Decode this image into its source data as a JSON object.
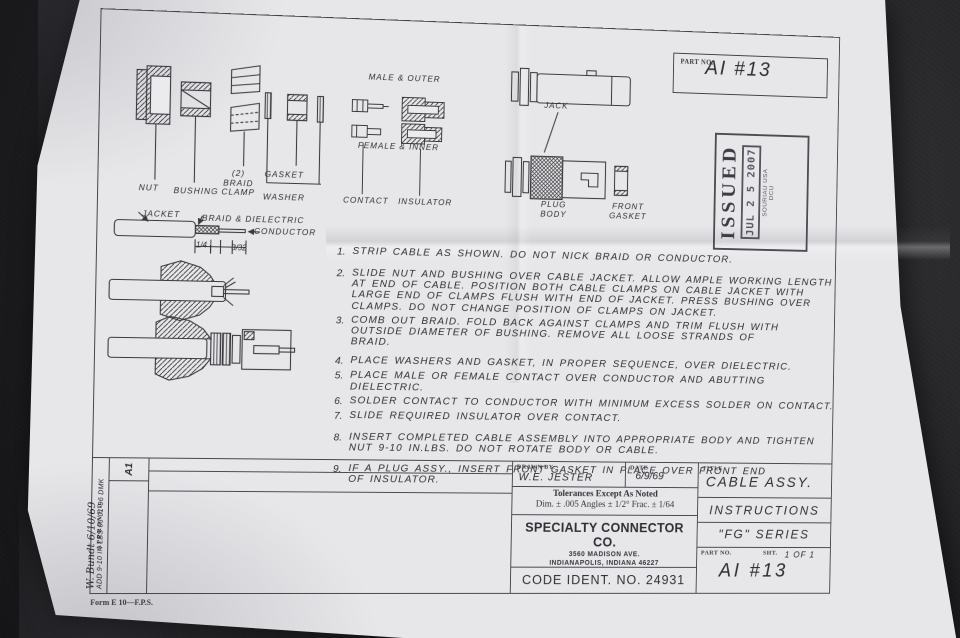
{
  "colors": {
    "desk_background": "#232326",
    "paper": "#e7e7ea",
    "ink": "#2e2e33"
  },
  "part_no_box": {
    "label": "PART NO.",
    "value": "AI #13"
  },
  "issued_stamp": {
    "word": "ISSUED",
    "date": "JUL 2 5 2007",
    "org": "SOURIAU USA\nDCU"
  },
  "exploded_parts": {
    "nut": "NUT",
    "bushing": "BUSHING",
    "braid_clamp": "(2)\nBRAID\nCLAMP",
    "gasket": "GASKET",
    "washer": "WASHER"
  },
  "contacts_diagram": {
    "male_outer": "MALE & OUTER",
    "female_inner": "FEMALE & INNER",
    "contact": "CONTACT",
    "insulator": "INSULATOR"
  },
  "bodies_diagram": {
    "jack": "JACK",
    "plug_body": "PLUG\nBODY",
    "front_gasket": "FRONT\nGASKET"
  },
  "strip_diagram": {
    "jacket": "JACKET",
    "braid_dielectric": "BRAID & DIELECTRIC",
    "conductor": "CONDUCTOR",
    "dim_1": "1/4",
    "dim_2": "3/32"
  },
  "instructions": [
    {
      "num": "1.",
      "text": "STRIP CABLE AS SHOWN.  DO NOT NICK BRAID OR CONDUCTOR."
    },
    {
      "num": "2.",
      "text": "SLIDE NUT AND BUSHING OVER CABLE JACKET. ALLOW AMPLE WORKING LENGTH\nAT END OF CABLE. POSITION BOTH CABLE CLAMPS ON CABLE JACKET WITH\nLARGE END OF CLAMPS FLUSH WITH END OF JACKET. PRESS BUSHING OVER\nCLAMPS. DO NOT CHANGE POSITION OF CLAMPS ON JACKET."
    },
    {
      "num": "3.",
      "text": "COMB OUT BRAID. FOLD BACK AGAINST CLAMPS AND TRIM FLUSH WITH\nOUTSIDE DIAMETER OF BUSHING. REMOVE ALL LOOSE STRANDS OF\nBRAID."
    },
    {
      "num": "4.",
      "text": "PLACE WASHERS AND GASKET, IN PROPER SEQUENCE, OVER DIELECTRIC."
    },
    {
      "num": "5.",
      "text": "PLACE MALE OR FEMALE CONTACT OVER CONDUCTOR AND ABUTTING DIELECTRIC."
    },
    {
      "num": "6.",
      "text": "SOLDER CONTACT TO CONDUCTOR WITH MINIMUM EXCESS SOLDER ON CONTACT."
    },
    {
      "num": "7.",
      "text": "SLIDE REQUIRED INSULATOR OVER CONTACT."
    },
    {
      "num": "8.",
      "text": "INSERT COMPLETED CABLE ASSEMBLY INTO APPROPRIATE BODY AND TIGHTEN\nNUT 9-10 IN.LBS. DO NOT ROTATE BODY OR CABLE."
    },
    {
      "num": "9.",
      "text": "IF A PLUG ASSY., INSERT FRONT GASKET IN PLACE OVER FRONT END\nOF INSULATOR."
    }
  ],
  "title_block": {
    "drawn_by_label": "DRAWN BY:",
    "drawn_by": "W.E. JESTER",
    "date_label": "DATE",
    "date": "6/9/69",
    "tolerances_title": "Tolerances Except As Noted",
    "tolerances_detail": "Dim. ± .005   Angles ± 1/2°   Frac. ± 1/64",
    "company": "SPECIALTY CONNECTOR CO.",
    "address_line1": "3560 MADISON AVE.",
    "address_line2": "INDIANAPOLIS, INDIANA 46227",
    "code_ident": "CODE IDENT. NO. 24931",
    "title_label": "TITLE",
    "title_line1": "CABLE ASSY.",
    "title_line2": "INSTRUCTIONS",
    "title_line3": "\"FG\" SERIES",
    "part_no_label": "PART NO.",
    "sht_label": "SHT.",
    "sheet": "1 OF 1",
    "part_no": "AI #13"
  },
  "approval_block": {
    "approved_label": "APPROVED",
    "rev": "A1",
    "signature": "W. Bundt  6/10/69",
    "note": "ADD 9-10 IN LBS  03-01-96  DMK",
    "form": "Form E 10—F.P.S."
  }
}
